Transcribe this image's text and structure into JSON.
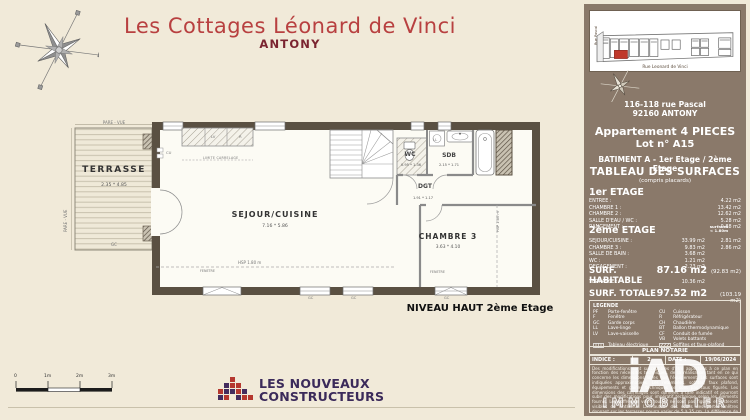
{
  "colors": {
    "page_bg": "#f1ead9",
    "title_red": "#b84040",
    "city_maroon": "#7a2430",
    "panel_brown": "#8a796a",
    "wall_dark": "#5a5042",
    "logo_purple": "#3b2a5a",
    "logo_red": "#b5382f",
    "site_unit_red": "#c0392b"
  },
  "title": {
    "main": "Les Cottages Léonard de Vinci",
    "city": "ANTONY"
  },
  "plan": {
    "terrasse": {
      "label": "TERRASSE",
      "dim": "2.35 * 4.85"
    },
    "sejour": {
      "label": "SEJOUR/CUISINE",
      "dim": "7.16 * 5.86"
    },
    "chambre3": {
      "label": "CHAMBRE 3",
      "dim": "3.63 * 4.10"
    },
    "wc": {
      "label": "WC",
      "dim": "0.95 * 1.36"
    },
    "sdb": {
      "label": "SDB",
      "dim": "2.15 * 1.71"
    },
    "dgt": {
      "label": "DGT",
      "dim": "1.91 * 1.17"
    },
    "pare_vue_top": "PARE - VUE",
    "pare_vue_left": "PARE - VUE",
    "gc_terrace": "GC",
    "gc_win1": "GC",
    "gc_win2": "GC",
    "gc_win3": "GC",
    "cu": "CU",
    "lv": "LV",
    "r": "R",
    "ll": "LL",
    "limite_carrelage": "LIMITE CARRELAGE",
    "hsp_h": "HSP 1.80 m",
    "hsp_v": "HSP 1.80 m",
    "fenetre1": "FENETRE",
    "fenetre2": "FENETRE",
    "level_label": "NIVEAU HAUT 2ème Etage",
    "scale_labels": [
      "0",
      "1m",
      "2m",
      "3m"
    ]
  },
  "logo": {
    "line1": "LES NOUVEAUX",
    "line2": "CONSTRUCTEURS"
  },
  "panel": {
    "siteplan": {
      "street_side": "Rue Pascal",
      "street_front": "Rue Leonard de Vinci"
    },
    "address1": "116-118 rue Pascal",
    "address2": "92160 ANTONY",
    "apartment": "Appartement 4 PIECES",
    "lot": "Lot n° A15",
    "batiment": "BATIMENT A - 1er Etage / 2ème Etage",
    "table_title": "TABLEAU DES SURFACES",
    "table_subtitle": "(compris placards)",
    "floor1": {
      "title": "1er ETAGE",
      "rows": [
        {
          "label": "ENTREE :",
          "value": "4.22 m2"
        },
        {
          "label": "CHAMBRE 1 :",
          "value": "13.42 m2"
        },
        {
          "label": "CHAMBRE 2 :",
          "value": "12.62 m2"
        },
        {
          "label": "SALLE D'EAU / WC :",
          "value": "5.28 m2"
        },
        {
          "label": "RANGEMENT :",
          "value": "0.88 m2"
        }
      ]
    },
    "floor2": {
      "title": "2ème ETAGE",
      "col_header_line1": "surfaces",
      "col_header_line2": "< 1.80m",
      "rows": [
        {
          "label": "SEJOUR/CUISINE :",
          "value": "33.99 m2",
          "value2": "2.81 m2"
        },
        {
          "label": "CHAMBRE 3 :",
          "value": "9.83 m2",
          "value2": "2.86 m2"
        },
        {
          "label": "SALLE DE BAIN :",
          "value": "3.68 m2",
          "value2": ""
        },
        {
          "label": "WC :",
          "value": "1.21 m2",
          "value2": ""
        },
        {
          "label": "DEGAGEMENT :",
          "value": "2.23 m2",
          "value2": ""
        }
      ]
    },
    "habitable": {
      "label": "SURF. HABITABLE",
      "value": "87.16 m2",
      "extra": "(92.83 m2)"
    },
    "terrasse_row": {
      "label": "TERRASSE :",
      "value": "10.36 m2"
    },
    "totale": {
      "label": "SURF. TOTALE",
      "value": "97.52 m2",
      "extra": "(103.19 m2)"
    },
    "legend": {
      "title": "LEGENDE",
      "left": [
        [
          "PF",
          "Porte-fenêtre"
        ],
        [
          "F",
          "Fenêtre"
        ],
        [
          "GC",
          "Garde corps"
        ],
        [
          "LL",
          "Lave-linge"
        ],
        [
          "LV",
          "Lave-vaisselle"
        ]
      ],
      "right": [
        [
          "CU",
          "Cuisson"
        ],
        [
          "R",
          "Réfrigérateur"
        ],
        [
          "CH",
          "Chaudière"
        ],
        [
          "BT",
          "Ballon thermodynamique"
        ],
        [
          "CF",
          "Conduit de fumée"
        ],
        [
          "VB",
          "Volets battants"
        ]
      ],
      "electrical": "Tableau électrique",
      "soffits": "Soffites et faux-plafond"
    },
    "notarie": {
      "title": "PLAN NOTARIE",
      "indice_label": "INDICE :",
      "indice_value": "2",
      "date_label": "DATE :",
      "date_value": "19/06/2024"
    },
    "disclaimer": "Des modifications sont susceptibles d'être apportées à ce plan en fonction des nécessités techniques, de la réalisation tant en ce qui concerne les dimensions libres que l'équipement. Les surfaces sont indiquées approximatives. Les retombées, soffites, faux plafond, équipements et gaines techniques ne sont pas tous figurés. Les dimensions des carrelages sont données à titre indicatif et pourront subir des modifications pour impératif technique selon les éléments fournis. Les coffres de volet roulant ne sont pas figurés et resteront visibles de l'intérieur. La hauteur des seuils des portes-fenêtres donnant sur les terrasses pourra varier de 5 à 35 cm. La différence de niveau entre le jardin et la terrasse pourra varier en fonction de l'encaissement et pourront s'adapter lors des ventes.",
    "watermark": {
      "line1": "iAD",
      "line2": "IMMOBILIER"
    }
  }
}
